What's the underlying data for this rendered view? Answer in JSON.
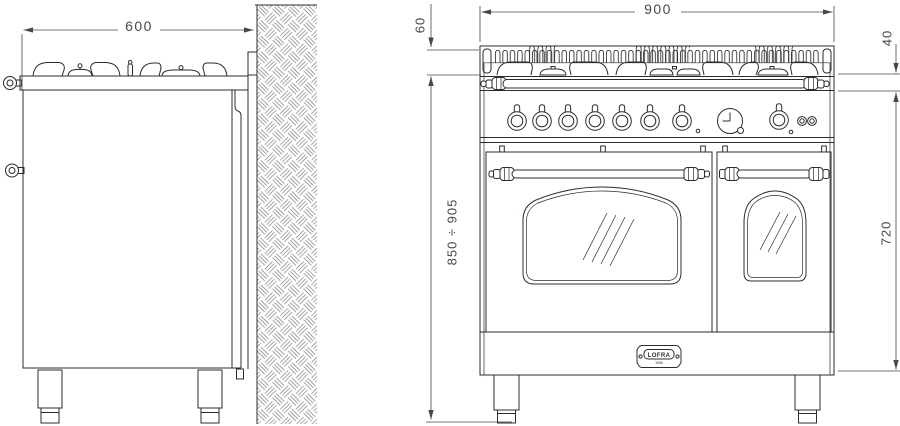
{
  "dimensions": {
    "side_width": "600",
    "front_width": "900",
    "grate_height": "60",
    "hob_edge_height": "40",
    "height_range": "850 ÷ 905",
    "body_height": "720"
  },
  "badge": {
    "brand": "LOFRA",
    "sub": "1956"
  },
  "colors": {
    "object_line": "#2a2d30",
    "dimension_line": "#45484c",
    "wall_hatch": "#7d8285",
    "background": "#ffffff"
  }
}
